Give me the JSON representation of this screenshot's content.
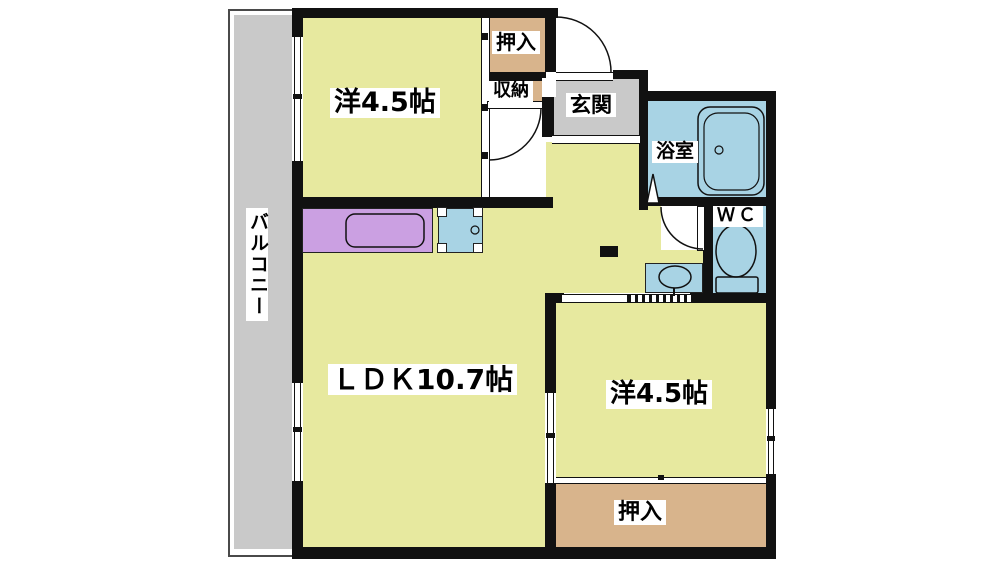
{
  "plan_title": "1LDK-apartment-floor-plan",
  "colors": {
    "room_fill": "#e7e99f",
    "closet_fill": "#d8b48c",
    "wet_fill": "#a8d3e4",
    "kitchen_counter_fill": "#cba0e2",
    "entry_fill": "#c9c9c9",
    "wall": "#111111",
    "balcony_fill": "#c9c9c9"
  },
  "rooms": {
    "balcony": {
      "label": "バルコニー"
    },
    "western_room_top": {
      "label": "洋4.5帖"
    },
    "oshiire_top": {
      "label": "押入"
    },
    "shuno": {
      "label": "収納"
    },
    "genkan": {
      "label": "玄関"
    },
    "bathroom": {
      "label": "浴室"
    },
    "wc": {
      "label": "ＷＣ"
    },
    "ldk": {
      "label": "ＬＤＫ10.7帖"
    },
    "western_room_bottom": {
      "label": "洋4.5帖"
    },
    "oshiire_bottom": {
      "label": "押入"
    }
  }
}
